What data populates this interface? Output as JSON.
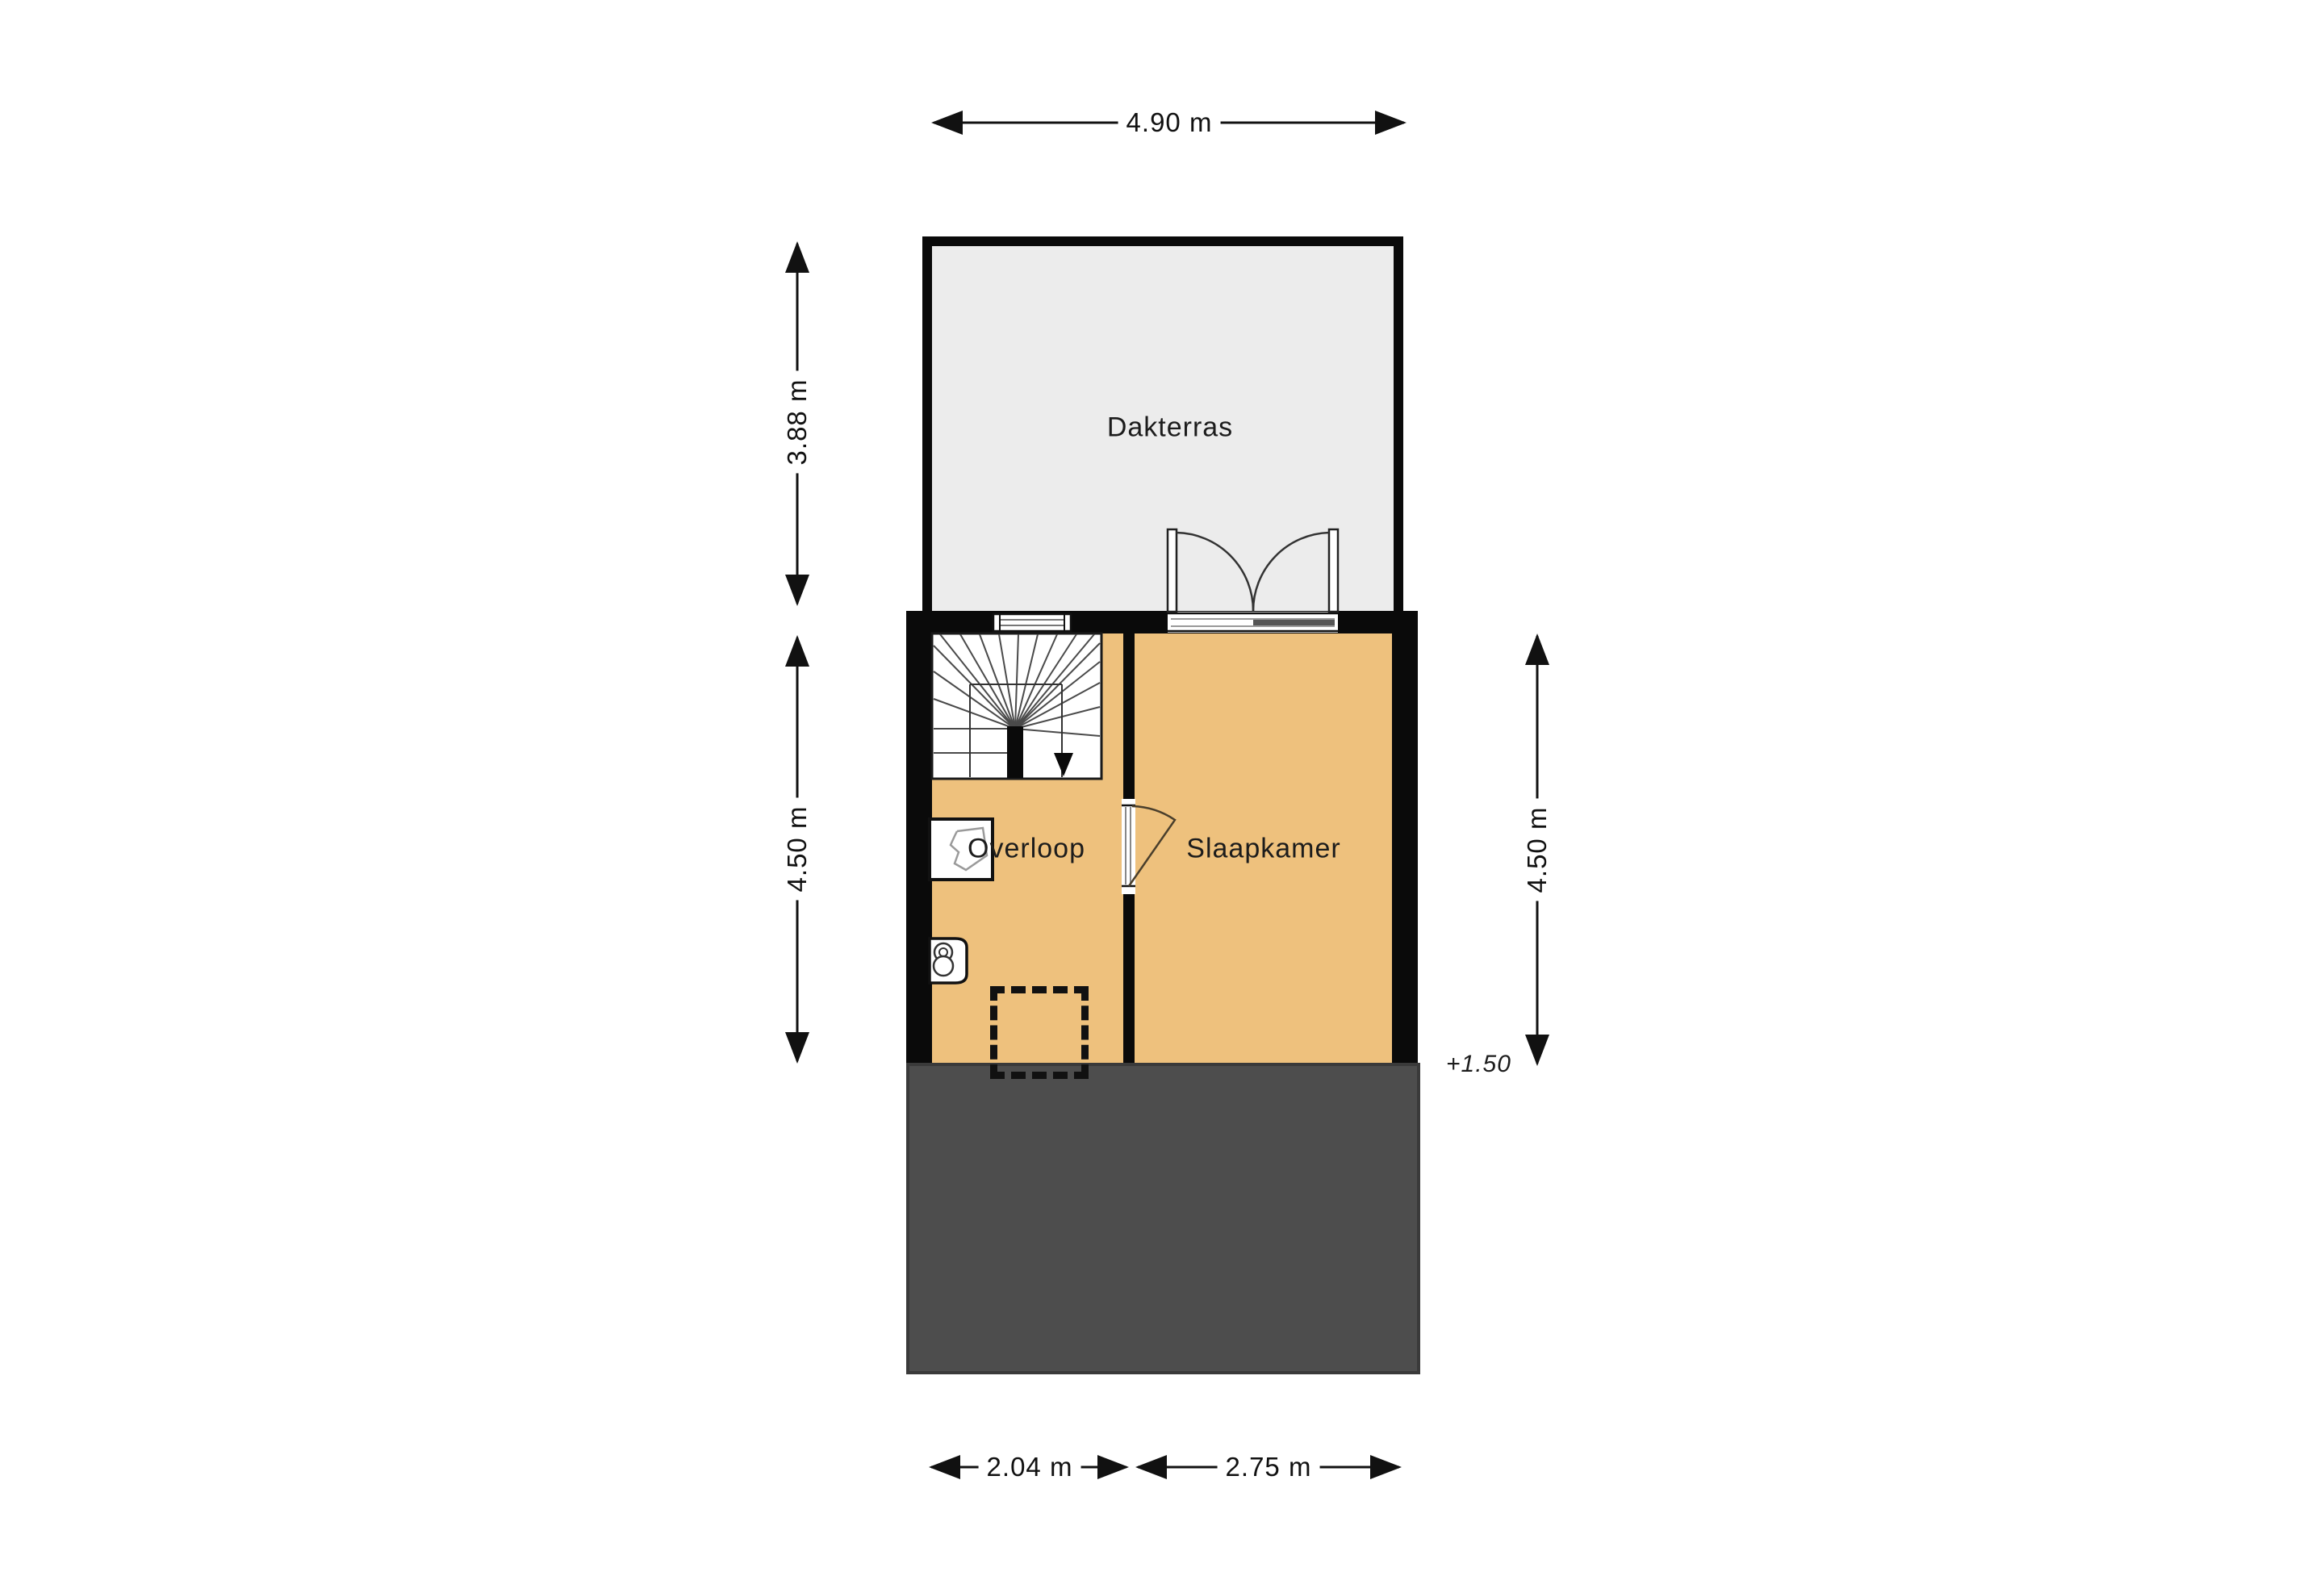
{
  "floorplan": {
    "title": "Floor plan - second floor with roof terrace",
    "rooms": [
      {
        "id": "dakterras",
        "label": "Dakterras"
      },
      {
        "id": "overloop",
        "label": "Overloop"
      },
      {
        "id": "slaapkamer",
        "label": "Slaapkamer"
      }
    ],
    "dimensions": {
      "top": "4.90 m",
      "left_upper": "3.88 m",
      "left_lower": "4.50 m",
      "right": "4.50 m",
      "bottom_left": "2.04 m",
      "bottom_right": "2.75 m"
    },
    "annotations": {
      "level": "+1.50"
    },
    "icons": {
      "stairs": "winder-staircase-with-down-arrow",
      "interior_door": "single-swing-door",
      "terrace_doors": "double-french-doors",
      "window": "triple-line-window",
      "toilet": "toilet-plan-symbol",
      "closet": "closet-plan-symbol",
      "roof_hatch": "dashed-rectangle"
    },
    "colors": {
      "background": "#ffffff",
      "floor": "#eec17d",
      "terrace": "#ececec",
      "wall": "#0a0a0a",
      "lower_roof": "#4d4d4d",
      "dimension_lines": "#111111"
    }
  }
}
